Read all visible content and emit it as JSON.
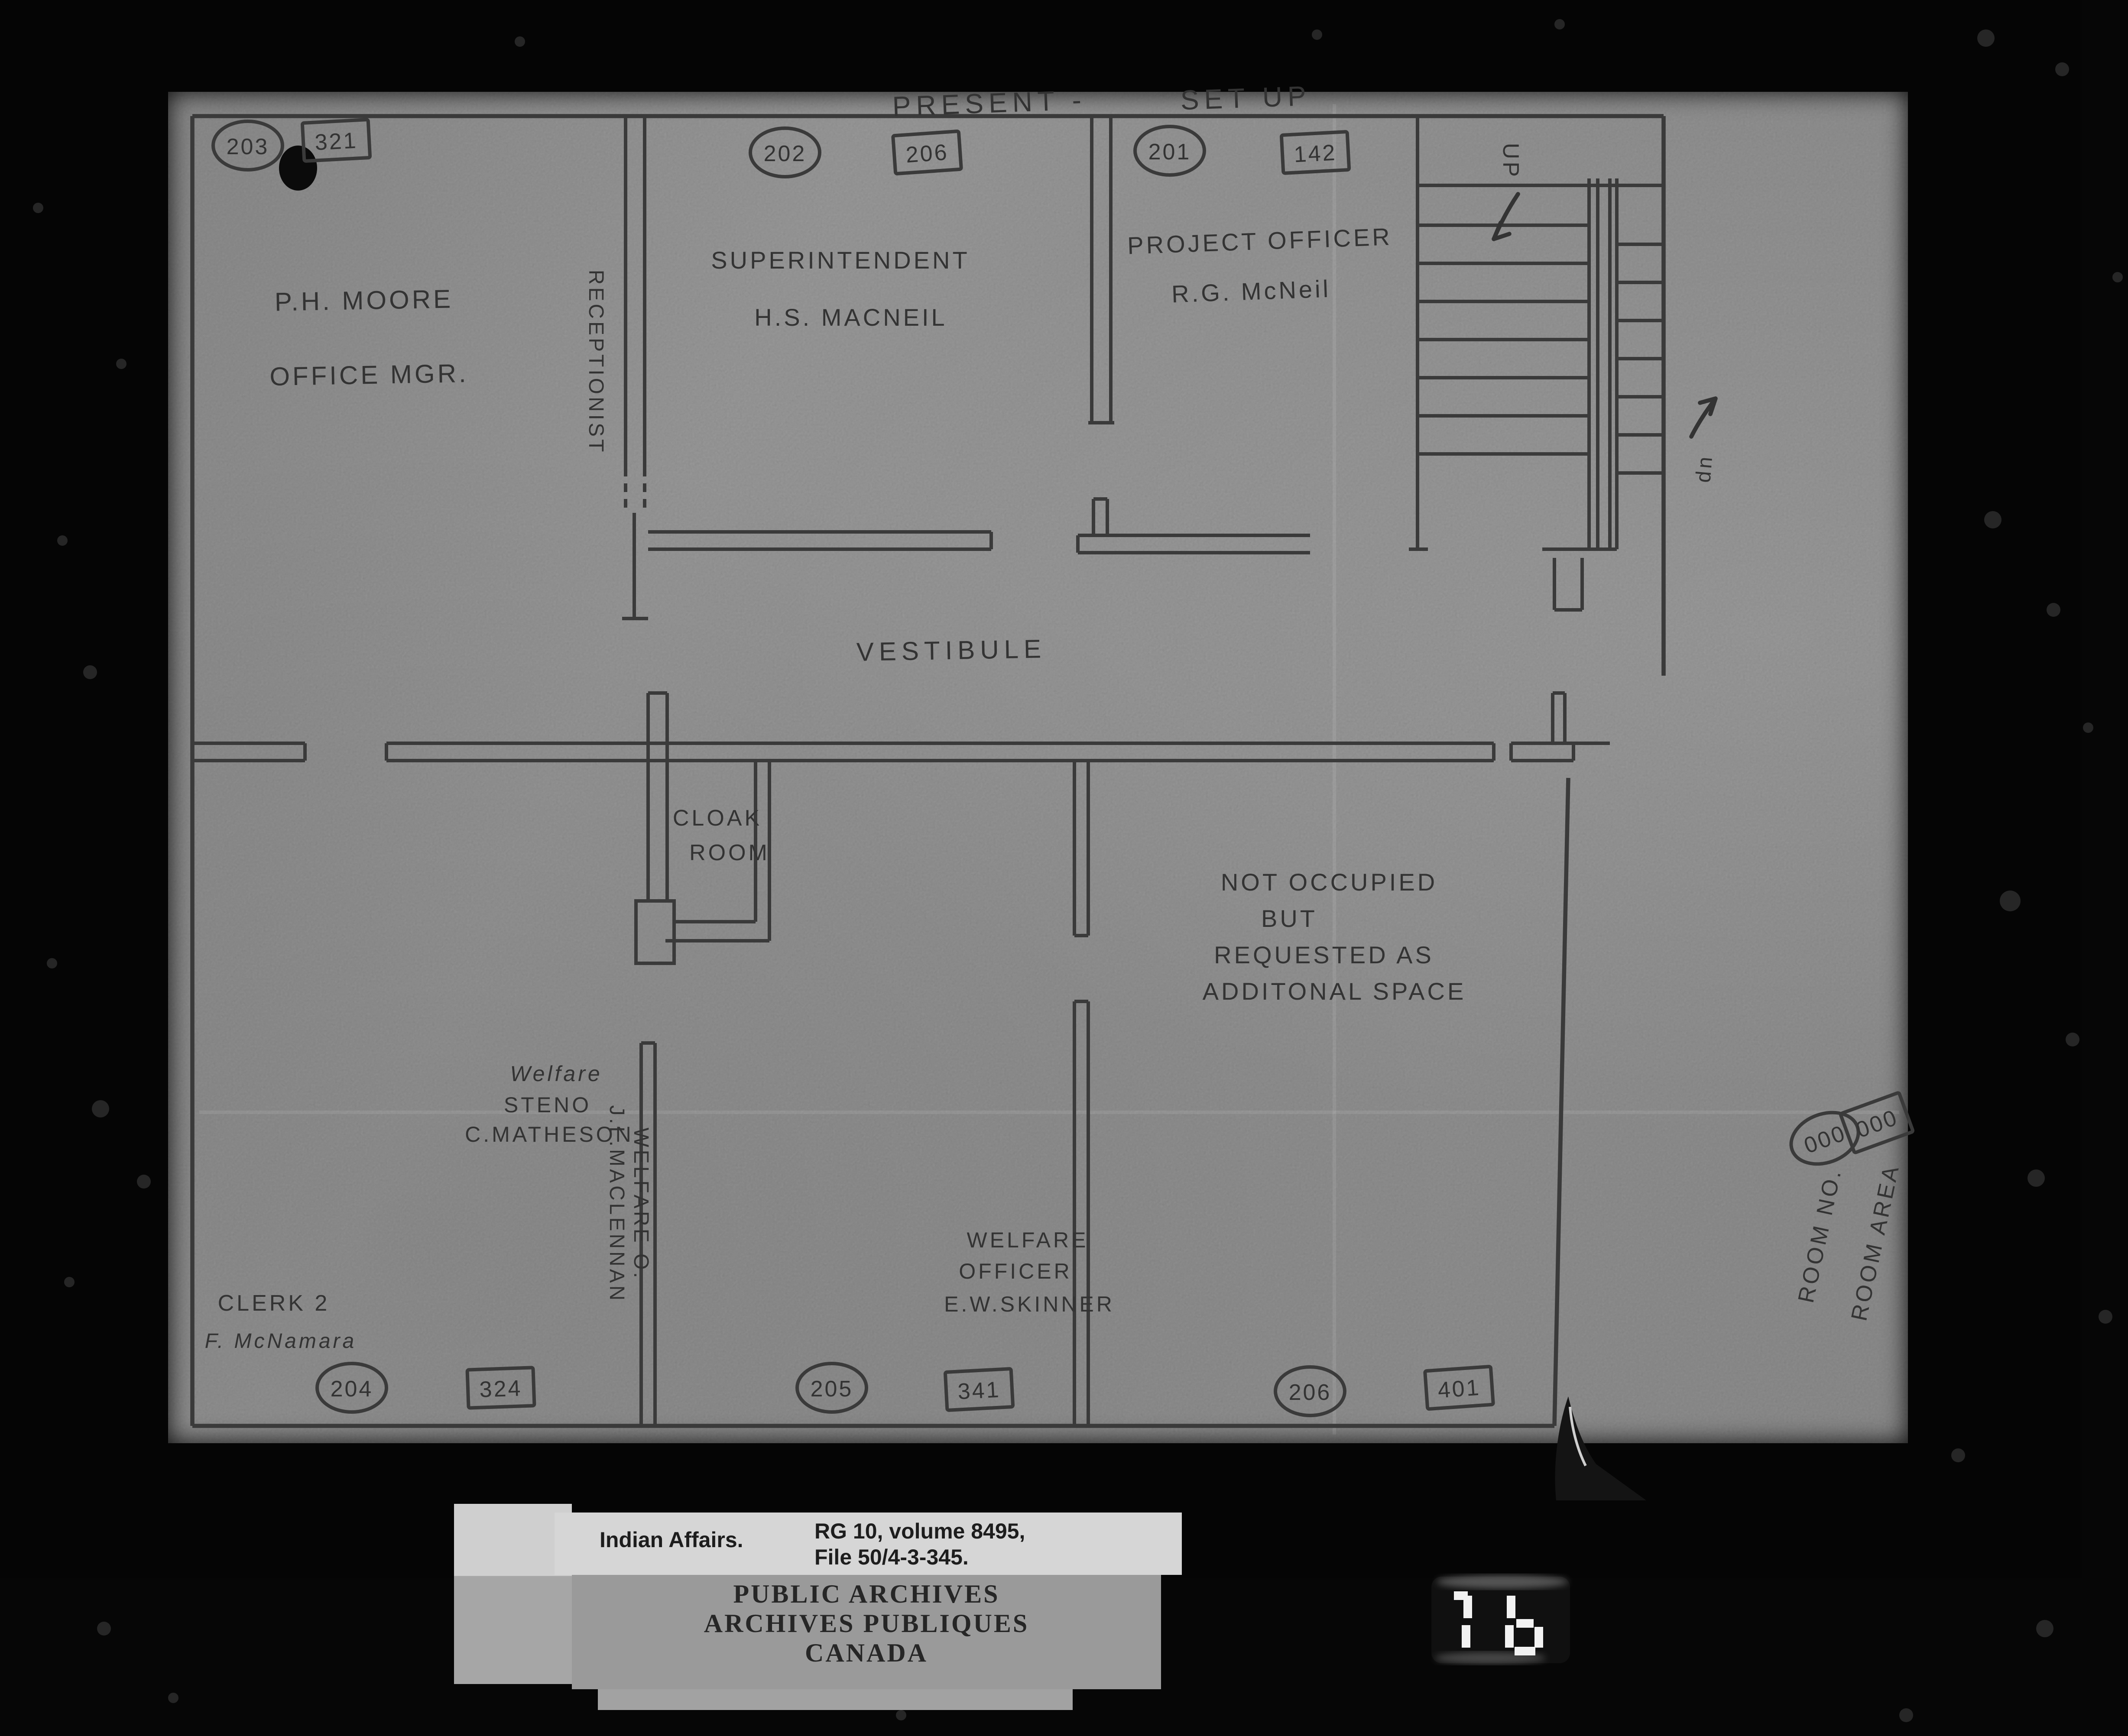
{
  "film": {
    "counter_display": "1 b"
  },
  "plan": {
    "title": {
      "left": "PRESENT -",
      "right": "SET UP"
    },
    "legend": {
      "room_no_label": "ROOM NO.",
      "room_no_value": "000",
      "room_area_label": "ROOM AREA",
      "room_area_value": "000"
    },
    "stairs": {
      "up_top": "UP",
      "up_bottom": "up"
    },
    "badges": [
      {
        "text": "203",
        "shape": "circle"
      },
      {
        "text": "321",
        "shape": "box"
      },
      {
        "text": "202",
        "shape": "circle"
      },
      {
        "text": "206",
        "shape": "box"
      },
      {
        "text": "201",
        "shape": "circle"
      },
      {
        "text": "142",
        "shape": "box"
      },
      {
        "text": "204",
        "shape": "circle"
      },
      {
        "text": "324",
        "shape": "box"
      },
      {
        "text": "205",
        "shape": "circle"
      },
      {
        "text": "341",
        "shape": "box"
      },
      {
        "text": "206",
        "shape": "circle"
      },
      {
        "text": "401",
        "shape": "box"
      }
    ],
    "rooms": {
      "office_mgr": {
        "l1": "P.H. MOORE",
        "l2": "OFFICE MGR."
      },
      "receptionist": "RECEPTIONIST",
      "superintendent": {
        "l1": "SUPERINTENDENT",
        "l2": "H.S. MACNEIL"
      },
      "project_officer": {
        "l1": "PROJECT OFFICER",
        "l2": "R.G. McNeil"
      },
      "vestibule": "VESTIBULE",
      "cloak_room": {
        "l1": "CLOAK",
        "l2": "ROOM"
      },
      "not_occupied": {
        "l1": "NOT OCCUPIED",
        "l2": "BUT",
        "l3": "REQUESTED AS",
        "l4": "ADDITONAL SPACE"
      },
      "welfare_steno": {
        "l1": "Welfare",
        "l2": "STENO",
        "l3": "C.MATHESON"
      },
      "welfare_officer_vert": {
        "l1": "WELFARE O.",
        "l2": "J.L.MACLENNAN"
      },
      "welfare_officer": {
        "l1": "WELFARE",
        "l2": "OFFICER",
        "l3": "E.W.SKINNER"
      },
      "clerk": {
        "l1": "CLERK 2",
        "l2": "F. McNamara"
      }
    }
  },
  "archive": {
    "collection": "Indian Affairs.",
    "reference_line1": "RG 10, volume 8495,",
    "reference_line2": "File 50/4-3-345.",
    "stamp_line1": "PUBLIC ARCHIVES",
    "stamp_line2": "ARCHIVES PUBLIQUES",
    "stamp_line3": "CANADA"
  }
}
